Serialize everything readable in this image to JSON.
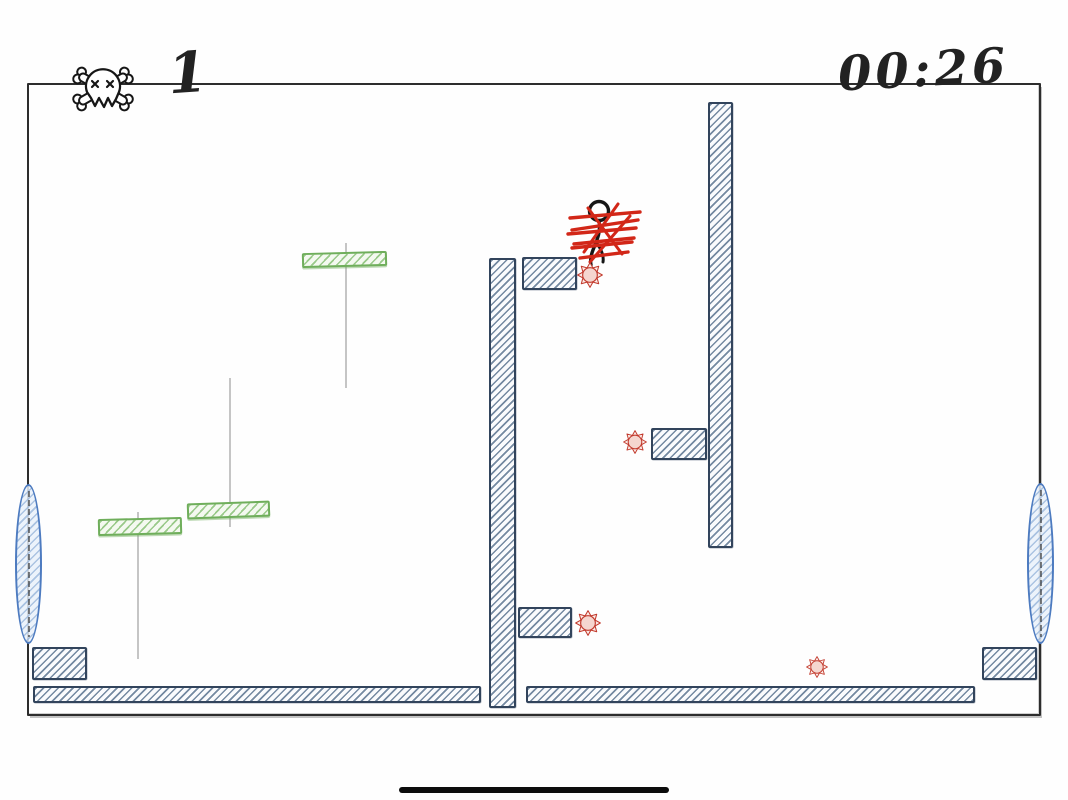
{
  "hud": {
    "deaths": {
      "icon": "skull-crossbones-icon",
      "count": "1"
    },
    "timer": {
      "value": "00:26"
    }
  },
  "colors": {
    "ink": "#222222",
    "platform_border": "#32445c",
    "platform_hatch": "#6d839c",
    "green_border": "#6fae5b",
    "green_hatch": "#8fc47e",
    "portal_border": "#4d7bc0",
    "portal_hatch": "#9ab7db",
    "hazard_red": "#c23a2d",
    "scribble_red": "#d22718"
  },
  "level": {
    "frame": {
      "x": 27,
      "y": 83,
      "w": 1014,
      "h": 633
    },
    "blocks": [
      {
        "name": "floor-left",
        "x": 33,
        "y": 686,
        "w": 448,
        "h": 17
      },
      {
        "name": "floor-right",
        "x": 526,
        "y": 686,
        "w": 449,
        "h": 17
      },
      {
        "name": "wall-center",
        "x": 489,
        "y": 258,
        "w": 27,
        "h": 450
      },
      {
        "name": "ledge-center-top",
        "x": 522,
        "y": 257,
        "w": 55,
        "h": 33
      },
      {
        "name": "ledge-center-mid",
        "x": 518,
        "y": 607,
        "w": 54,
        "h": 31
      },
      {
        "name": "wall-right",
        "x": 708,
        "y": 102,
        "w": 25,
        "h": 446
      },
      {
        "name": "ledge-right-wall",
        "x": 651,
        "y": 428,
        "w": 56,
        "h": 32
      },
      {
        "name": "block-bottom-left",
        "x": 32,
        "y": 647,
        "w": 55,
        "h": 33
      },
      {
        "name": "block-bottom-right",
        "x": 982,
        "y": 647,
        "w": 55,
        "h": 33
      }
    ],
    "green_platforms": [
      {
        "name": "green-platform-top",
        "x": 302,
        "y": 252,
        "w": 85,
        "h": 15,
        "tilt": -1.5
      },
      {
        "name": "green-platform-middle",
        "x": 187,
        "y": 502,
        "w": 83,
        "h": 16,
        "tilt": -2
      },
      {
        "name": "green-platform-left",
        "x": 98,
        "y": 518,
        "w": 84,
        "h": 17,
        "tilt": -1.5
      }
    ],
    "tracks": [
      {
        "name": "track-top",
        "x": 345,
        "y": 243,
        "h": 145
      },
      {
        "name": "track-middle",
        "x": 229,
        "y": 378,
        "h": 149
      },
      {
        "name": "track-left",
        "x": 137,
        "y": 512,
        "h": 147
      }
    ],
    "portals": [
      {
        "name": "portal-left",
        "x": 15,
        "y": 484,
        "w": 27,
        "h": 160
      },
      {
        "name": "portal-right",
        "x": 1027,
        "y": 483,
        "w": 27,
        "h": 161
      }
    ],
    "hazards": [
      {
        "x": 590,
        "y": 275,
        "r": 13
      },
      {
        "x": 635,
        "y": 442,
        "r": 12
      },
      {
        "x": 588,
        "y": 623,
        "r": 13
      },
      {
        "x": 817,
        "y": 667,
        "r": 11
      }
    ],
    "player": {
      "x": 560,
      "y": 190,
      "w": 90,
      "h": 84
    }
  },
  "system": {
    "home_indicator": {
      "x": 399,
      "y": 787,
      "w": 270,
      "h": 6
    }
  }
}
